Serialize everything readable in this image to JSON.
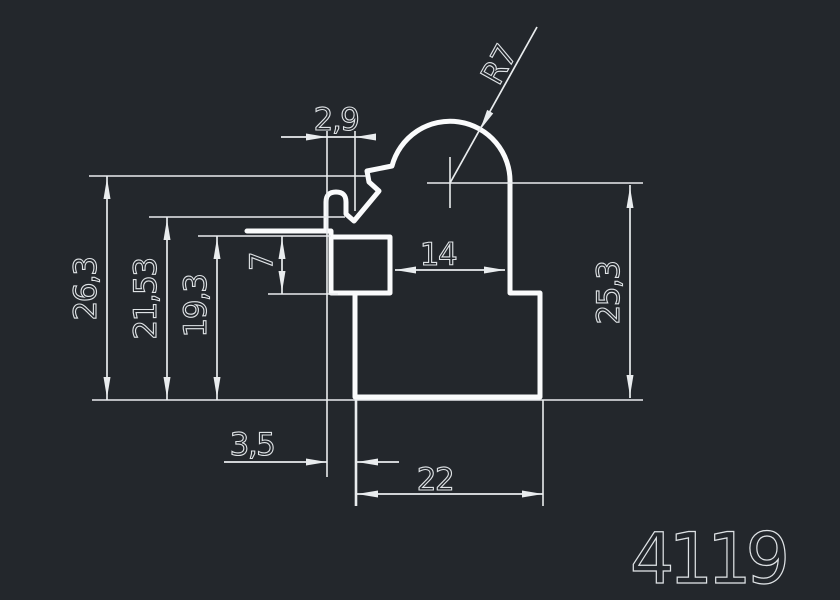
{
  "drawing": {
    "part_number": "4119",
    "type_label": "extrusion-profile-cross-section"
  },
  "colors": {
    "background": "#23272c",
    "geometry": "#fafbfc",
    "dimensions": "#e9ecee",
    "text": "#dfe3e6"
  },
  "dims": {
    "width_top": "2,9",
    "radius": "R7",
    "inner_width": "14",
    "height_total": "26,3",
    "height_upper": "21,53",
    "height_mid": "19,3",
    "notch_height": "7",
    "height_right": "25,3",
    "offset_bottom": "3,5",
    "width_base": "22"
  }
}
